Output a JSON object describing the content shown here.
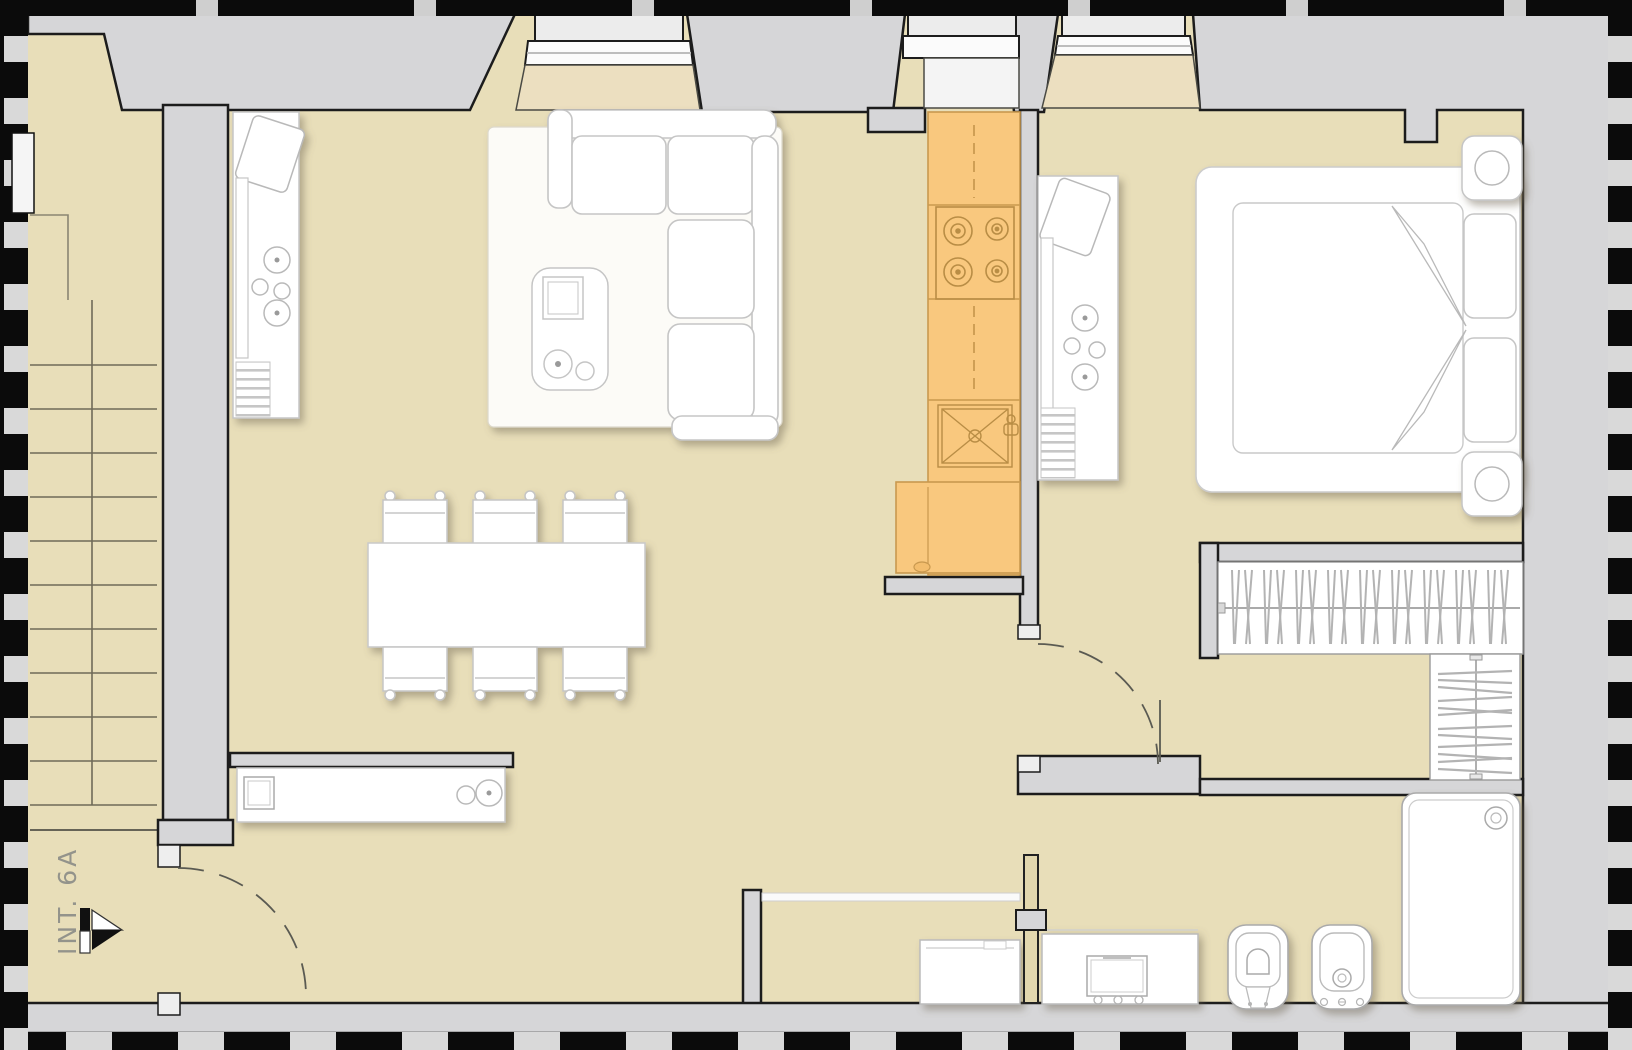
{
  "document": {
    "type": "architectural-floor-plan",
    "description": "One-bedroom apartment plan with stairwell, living-dining room, galley kitchen, bedroom and bathroom"
  },
  "entrance": {
    "label": "INT. 6A",
    "marker": "entrance-arrow"
  },
  "colors": {
    "floor_beige": "#e8deb9",
    "wall_gray": "#d6d6d8",
    "kitchen_orange": "#f9c87e",
    "kitchen_line": "#c9994f",
    "furniture_white": "#ffffff",
    "outline_black": "#1c1c1c",
    "frame_black": "#0b0b0b",
    "label_gray": "#93938b"
  },
  "rooms": [
    {
      "name": "stairwell",
      "features": [
        "staircase with treads",
        "landing",
        "unit entrance"
      ]
    },
    {
      "name": "living-dining-room",
      "features": [
        "corner sofa on rug",
        "coffee table",
        "dining table",
        "6 chairs",
        "desk with chair",
        "sideboard"
      ]
    },
    {
      "name": "kitchen",
      "features": [
        "counter run",
        "4-burner cooktop",
        "sink",
        "refrigerator",
        "window"
      ]
    },
    {
      "name": "bedroom",
      "features": [
        "double bed",
        "2 pillows",
        "2 nightstands with lamps",
        "desk with chair",
        "hanging wardrobe",
        "shelved wardrobe",
        "window"
      ]
    },
    {
      "name": "bathroom",
      "features": [
        "vanity with basin",
        "toilet",
        "bidet",
        "shower tray",
        "washing machine",
        "laundry niche"
      ]
    }
  ],
  "doors": [
    {
      "name": "entrance-door",
      "type": "swing-arc"
    },
    {
      "name": "bedroom-door",
      "type": "swing-arc"
    },
    {
      "name": "bathroom-door",
      "type": "open-leaf"
    }
  ],
  "windows": [
    {
      "name": "living-room-window"
    },
    {
      "name": "kitchen-window"
    },
    {
      "name": "bedroom-window"
    }
  ]
}
